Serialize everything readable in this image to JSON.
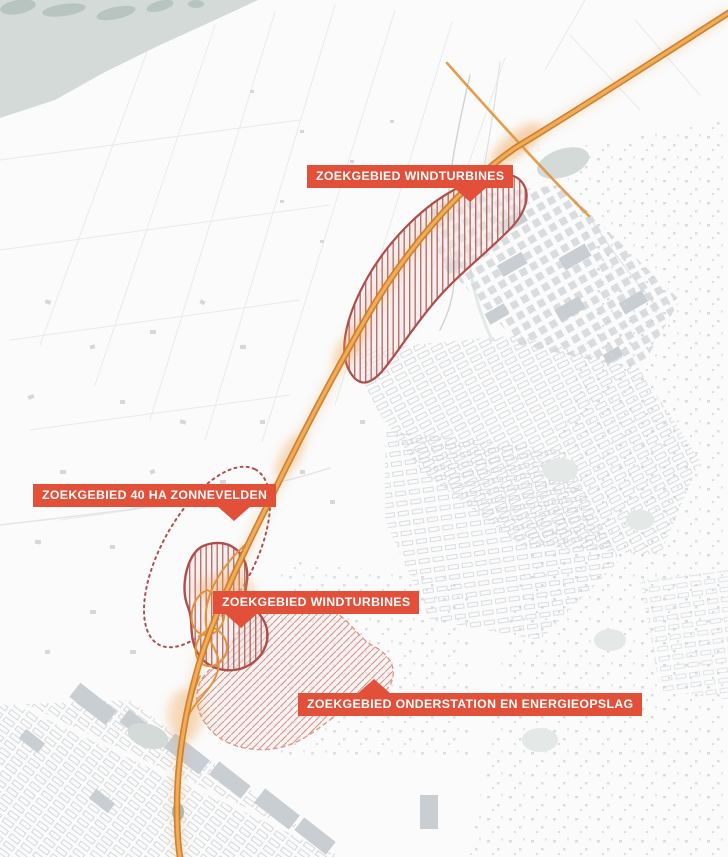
{
  "map": {
    "title": "Zoekgebieden energieprojecten kaart",
    "labels": [
      {
        "text": "ZOEKGEBIED WINDTURBINES"
      },
      {
        "text": "ZOEKGEBIED 40 HA ZONNEVELDEN"
      },
      {
        "text": "ZOEKGEBIED WINDTURBINES"
      },
      {
        "text": "ZOEKGEBIED ONDERSTATION EN ENERGIEOPSLAG"
      }
    ],
    "regions": [
      {
        "id": "windturbines-noord",
        "style": "vertical-hatch",
        "label": "ZOEKGEBIED WINDTURBINES"
      },
      {
        "id": "zonnevelden-40ha",
        "style": "dotted-outline",
        "label": "ZOEKGEBIED 40 HA ZONNEVELDEN"
      },
      {
        "id": "windturbines-zuid",
        "style": "vertical-hatch",
        "label": "ZOEKGEBIED WINDTURBINES"
      },
      {
        "id": "onderstation-energieopslag",
        "style": "diagonal-hatch",
        "label": "ZOEKGEBIED ONDERSTATION EN ENERGIEOPSLAG"
      }
    ],
    "colors": {
      "background": "#fbfbfb",
      "water": "#d3dad8",
      "bank": "#b7c4bf",
      "pond_dark": "#a9bcb4",
      "stream": "#ccd5d3",
      "parcel_line": "#e7eae9",
      "faint_road": "#e0e4e4",
      "building": "#d4d8db",
      "building_dark": "#c9ced3",
      "building_row": "#ced3d7",
      "park": "#e4e8e7",
      "label_bg": "#e2503a",
      "label_text": "#ffffff",
      "road_outer": "#c87c2b",
      "road_inner": "#f3ab56",
      "road_glow": "#f09a3f",
      "road_ramp": "#e2923c",
      "hatch_red": "#a85250",
      "region_outline": "#ae4f4b",
      "region_fill_tint": "#f3e4e1",
      "diag_hatch": "#cf8478",
      "diag_outline": "#dd9a8c",
      "diag_fill_tint": "#f8efec"
    }
  }
}
